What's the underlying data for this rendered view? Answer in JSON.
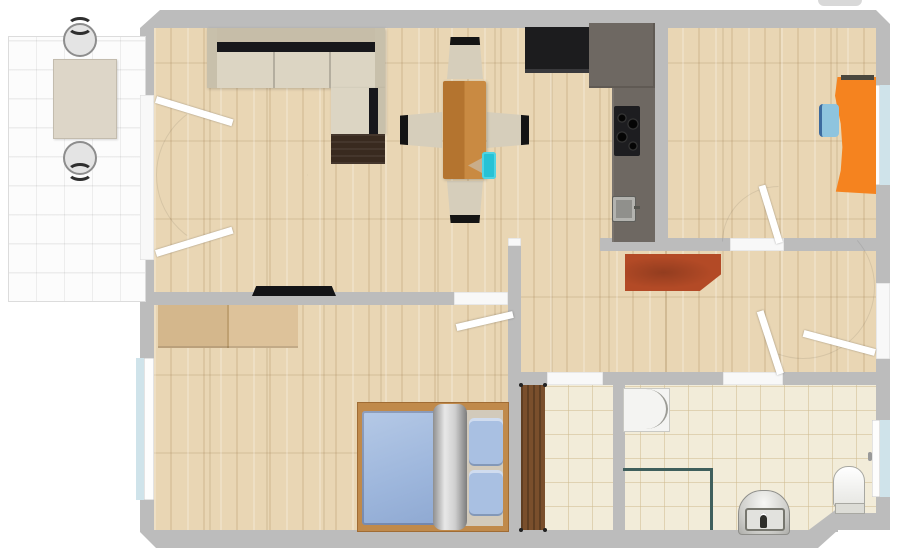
{
  "app": {
    "type": "floor-plan-viewer",
    "visible_text": ""
  },
  "palette": {
    "wall": "#bcbcbc",
    "wood_floor": "#e9d6b4",
    "bath_tile": "#f2ecd9",
    "balcony_tile": "#fcfcfc",
    "sofa_beige": "#d9d2c0",
    "table_wood": "#c07b3a",
    "counter_gray": "#6e6862",
    "appliance_black": "#1c1c1e",
    "desk_orange": "#f5831f",
    "chair_blue": "#8ec4de",
    "wardrobe_red": "#b34a26",
    "wardrobe_tan": "#d9bc92",
    "bed_frame": "#c08a4b",
    "bed_blue": "#a2bbdf",
    "door_brown": "#7a4f2c",
    "window_blue": "#cfe3ea",
    "shower_glass": "#3f5f5c",
    "fixture_white": "#f4f4f2",
    "accent_cyan": "#27c2d5"
  },
  "rooms": {
    "living_room": {
      "title": "living room",
      "floor": "wood"
    },
    "kitchen": {
      "title": "kitchen nook",
      "floor": "wood"
    },
    "office": {
      "title": "office room",
      "floor": "wood"
    },
    "hallway": {
      "title": "hallway",
      "floor": "wood"
    },
    "bedroom": {
      "title": "bedroom",
      "floor": "wood"
    },
    "storage": {
      "title": "storage room",
      "floor": "tile"
    },
    "bathroom": {
      "title": "bathroom",
      "floor": "tile"
    },
    "balcony": {
      "title": "balcony",
      "floor": "white tile"
    }
  },
  "furniture": {
    "balcony_table": {
      "title": "balcony table"
    },
    "balcony_chair_top": {
      "title": "balcony chair"
    },
    "balcony_chair_bottom": {
      "title": "balcony chair"
    },
    "corner_sofa": {
      "title": "corner sofa"
    },
    "sofa_chest": {
      "title": "sofa chest"
    },
    "tv": {
      "title": "tv"
    },
    "dining_table": {
      "title": "dining table"
    },
    "dining_chair_top": {
      "title": "dining chair"
    },
    "dining_chair_bottom": {
      "title": "dining chair"
    },
    "dining_chair_left": {
      "title": "dining chair"
    },
    "dining_chair_right": {
      "title": "dining chair"
    },
    "table_accessory": {
      "title": "tablet on table"
    },
    "kitchen_appliance": {
      "title": "kitchen appliance"
    },
    "kitchen_counter": {
      "title": "kitchen counter"
    },
    "cooktop": {
      "title": "cooktop"
    },
    "kitchen_sink": {
      "title": "kitchen sink"
    },
    "desk": {
      "title": "desk"
    },
    "desk_chair": {
      "title": "desk chair"
    },
    "laptop": {
      "title": "laptop"
    },
    "hall_wardrobe": {
      "title": "hall wardrobe"
    },
    "bedroom_wardrobe": {
      "title": "bedroom wardrobe"
    },
    "double_bed": {
      "title": "double bed"
    },
    "storage_door_panel": {
      "title": "storage door"
    },
    "washing_machine": {
      "title": "washing machine"
    },
    "shower": {
      "title": "shower enclosure"
    },
    "bathroom_sink": {
      "title": "bathroom sink"
    },
    "toilet": {
      "title": "toilet"
    }
  },
  "openings": {
    "balcony_french_doors": {
      "title": "balcony french doors"
    },
    "bedroom_door": {
      "title": "bedroom door"
    },
    "office_door": {
      "title": "office door"
    },
    "bathroom_door": {
      "title": "bathroom door"
    },
    "storage_opening": {
      "title": "storage opening"
    },
    "entrance_door": {
      "title": "entrance door"
    },
    "bedroom_window": {
      "title": "bedroom window"
    },
    "office_window": {
      "title": "office window"
    },
    "bathroom_window": {
      "title": "bathroom window"
    }
  }
}
